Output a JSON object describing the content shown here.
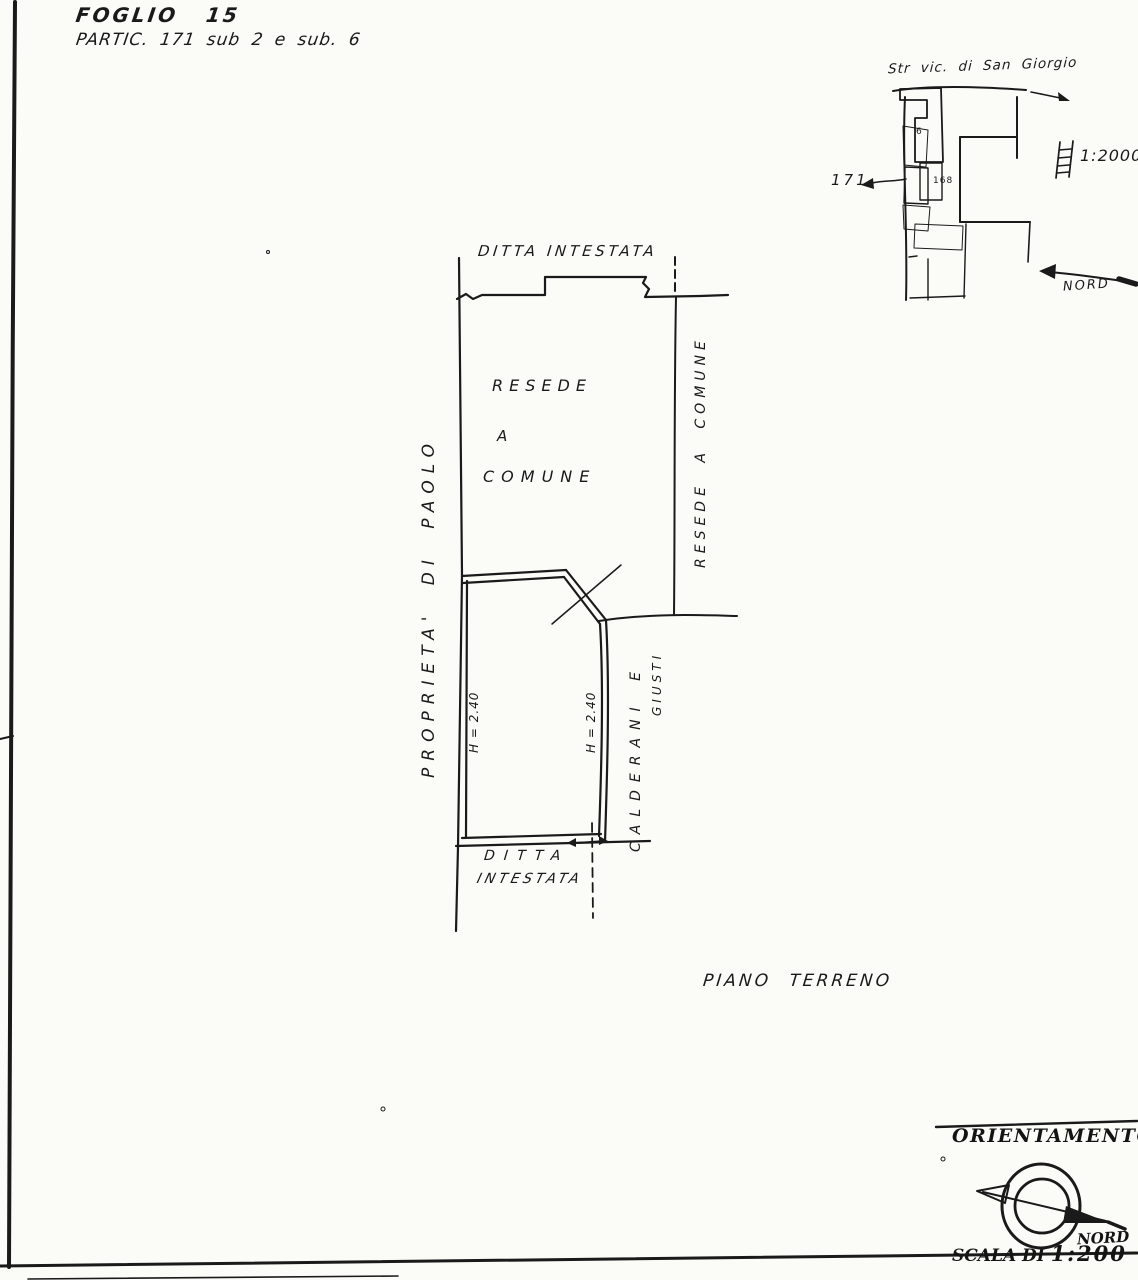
{
  "page": {
    "foglio_line": "FOGLIO 15",
    "partic_line": "PARTIC. 171 sub 2 e sub. 6"
  },
  "locator_map": {
    "street_label": "Str vic. di San Giorgio",
    "scale_note": "1:2000",
    "parcel_number": "171",
    "sub_label": "6",
    "adjacent_parcel": "168",
    "north_label": "NORD"
  },
  "plan": {
    "top_neighbor_label": "DITTA INTESTATA",
    "courtyard_label_line1": "RESEDE",
    "courtyard_label_line2": "A",
    "courtyard_label_line3": "COMUNE",
    "right_boundary_label": "RESEDE A COMUNE",
    "left_boundary_label": "PROPRIETA' DI PAOLO",
    "neighbor_right_line1": "CALDERANI E",
    "neighbor_right_line2": "GIUSTI",
    "height_left": "H = 2.40",
    "height_right": "H = 2.40",
    "bottom_neighbor_line1": "DITTA",
    "bottom_neighbor_line2": "INTESTATA",
    "floor_label": "PIANO TERRENO"
  },
  "orientation": {
    "title": "ORIENTAMENTO",
    "north_label": "NORD",
    "scale_label": "SCALA DI",
    "scale_value": "1:200"
  }
}
